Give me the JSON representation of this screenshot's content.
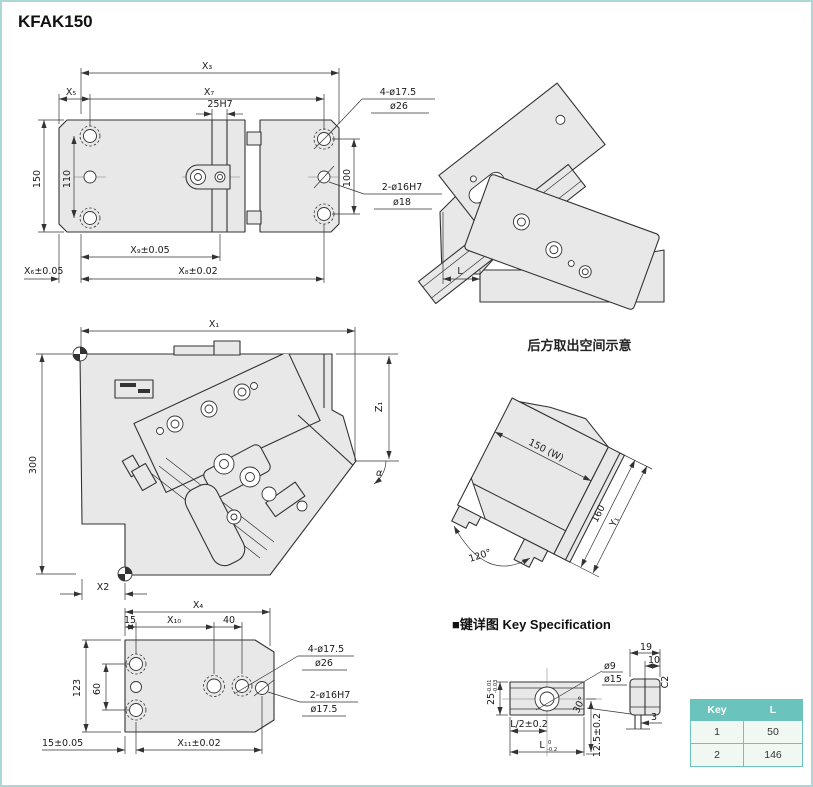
{
  "meta": {
    "title": "KFAK150"
  },
  "colors": {
    "accent_teal": "#6ac3bd",
    "table_row_bg": "#f1f8f2",
    "page_border": "#abd8d6",
    "line": "#333333",
    "part_fill": "#e8e8e8"
  },
  "plan_view": {
    "x3": "X₃",
    "x5": "X₅",
    "x7": "X₇",
    "keyway": "25H7",
    "h150": "150",
    "h110": "110",
    "v100": "100",
    "x9": "X₉±0.05",
    "x6": "X₆±0.05",
    "x8": "X₈±0.02",
    "callout_cb1": "4-ø17.5",
    "callout_cb2": "ø26",
    "callout_pin1": "2-ø16H7",
    "callout_pin2": "ø18"
  },
  "side_view": {
    "l": "L"
  },
  "front_view": {
    "x1": "X₁",
    "h300": "300",
    "z1": "Z₁",
    "alpha": "α",
    "x2": "X2"
  },
  "rear_view": {
    "title": "后方取出空间示意",
    "w": "150 (W)",
    "d160": "160",
    "y1": "Y₁",
    "angle": "120°"
  },
  "bottom_view": {
    "x4": "X₄",
    "d15": "15",
    "x10": "X₁₀",
    "d40": "40",
    "h123": "123",
    "h60": "60",
    "b15": "15±0.05",
    "x11": "X₁₁±0.02",
    "callout_cb1": "4-ø17.5",
    "callout_cb2": "ø26",
    "callout_pin1": "2-ø16H7",
    "callout_pin2": "ø17.5"
  },
  "key_spec": {
    "heading": "■键详图 Key Specification",
    "d9": "ø9",
    "d15": "ø15",
    "w25": "25",
    "w25_tol_hi": "-0.01",
    "w25_tol_lo": "-0.03",
    "l_half": "L/2±0.2",
    "l_main": "L",
    "l_tol_hi": "0",
    "l_tol_lo": "-0.2",
    "h125": "12.5±0.2",
    "d19": "19",
    "d10": "10",
    "c2": "C2",
    "a30": "30°",
    "d3": "3"
  },
  "key_table": {
    "headers": [
      "Key",
      "L"
    ],
    "rows": [
      {
        "key": "1",
        "l": "50"
      },
      {
        "key": "2",
        "l": "146"
      }
    ]
  }
}
